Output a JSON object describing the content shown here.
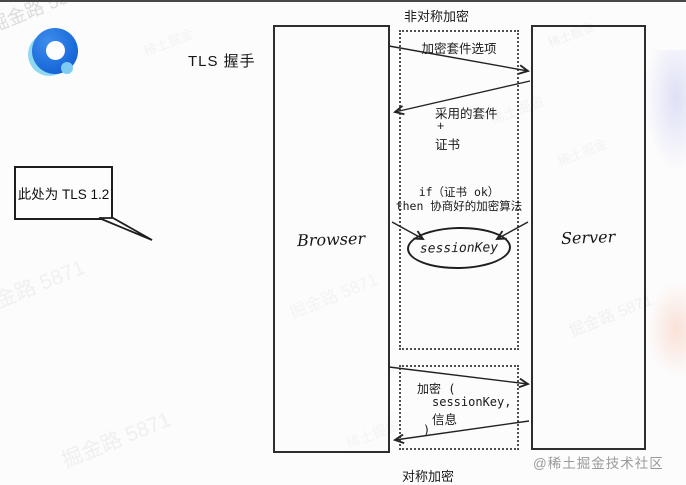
{
  "header": {
    "tls_title": "TLS 握手"
  },
  "bubble": {
    "text": "此处为 TLS 1.2"
  },
  "diagram": {
    "asym_label": "非对称加密",
    "sym_label": "对称加密",
    "browser_label": "Browser",
    "server_label": "Server",
    "cipher_options": "加密套件选项",
    "adopted_suite": "采用的套件",
    "plus": "+",
    "certificate": "证书",
    "cond_if": "if（证书 ok）",
    "cond_then": "then 协商好的加密算法",
    "session_key": "sessionKey",
    "encrypt_open": "加密 (",
    "encrypt_key": "sessionKey,",
    "encrypt_msg": "信息",
    "encrypt_close": ")"
  },
  "watermarks": {
    "main": "掘金路 5871",
    "small": "稀土掘金"
  },
  "credit": "@稀土掘金技术社区",
  "colors": {
    "ink": "#222222",
    "logo_blue": "#1f6fdd",
    "logo_light_blue": "#8fd8f0",
    "credit_gray": "#9a9a9a"
  }
}
